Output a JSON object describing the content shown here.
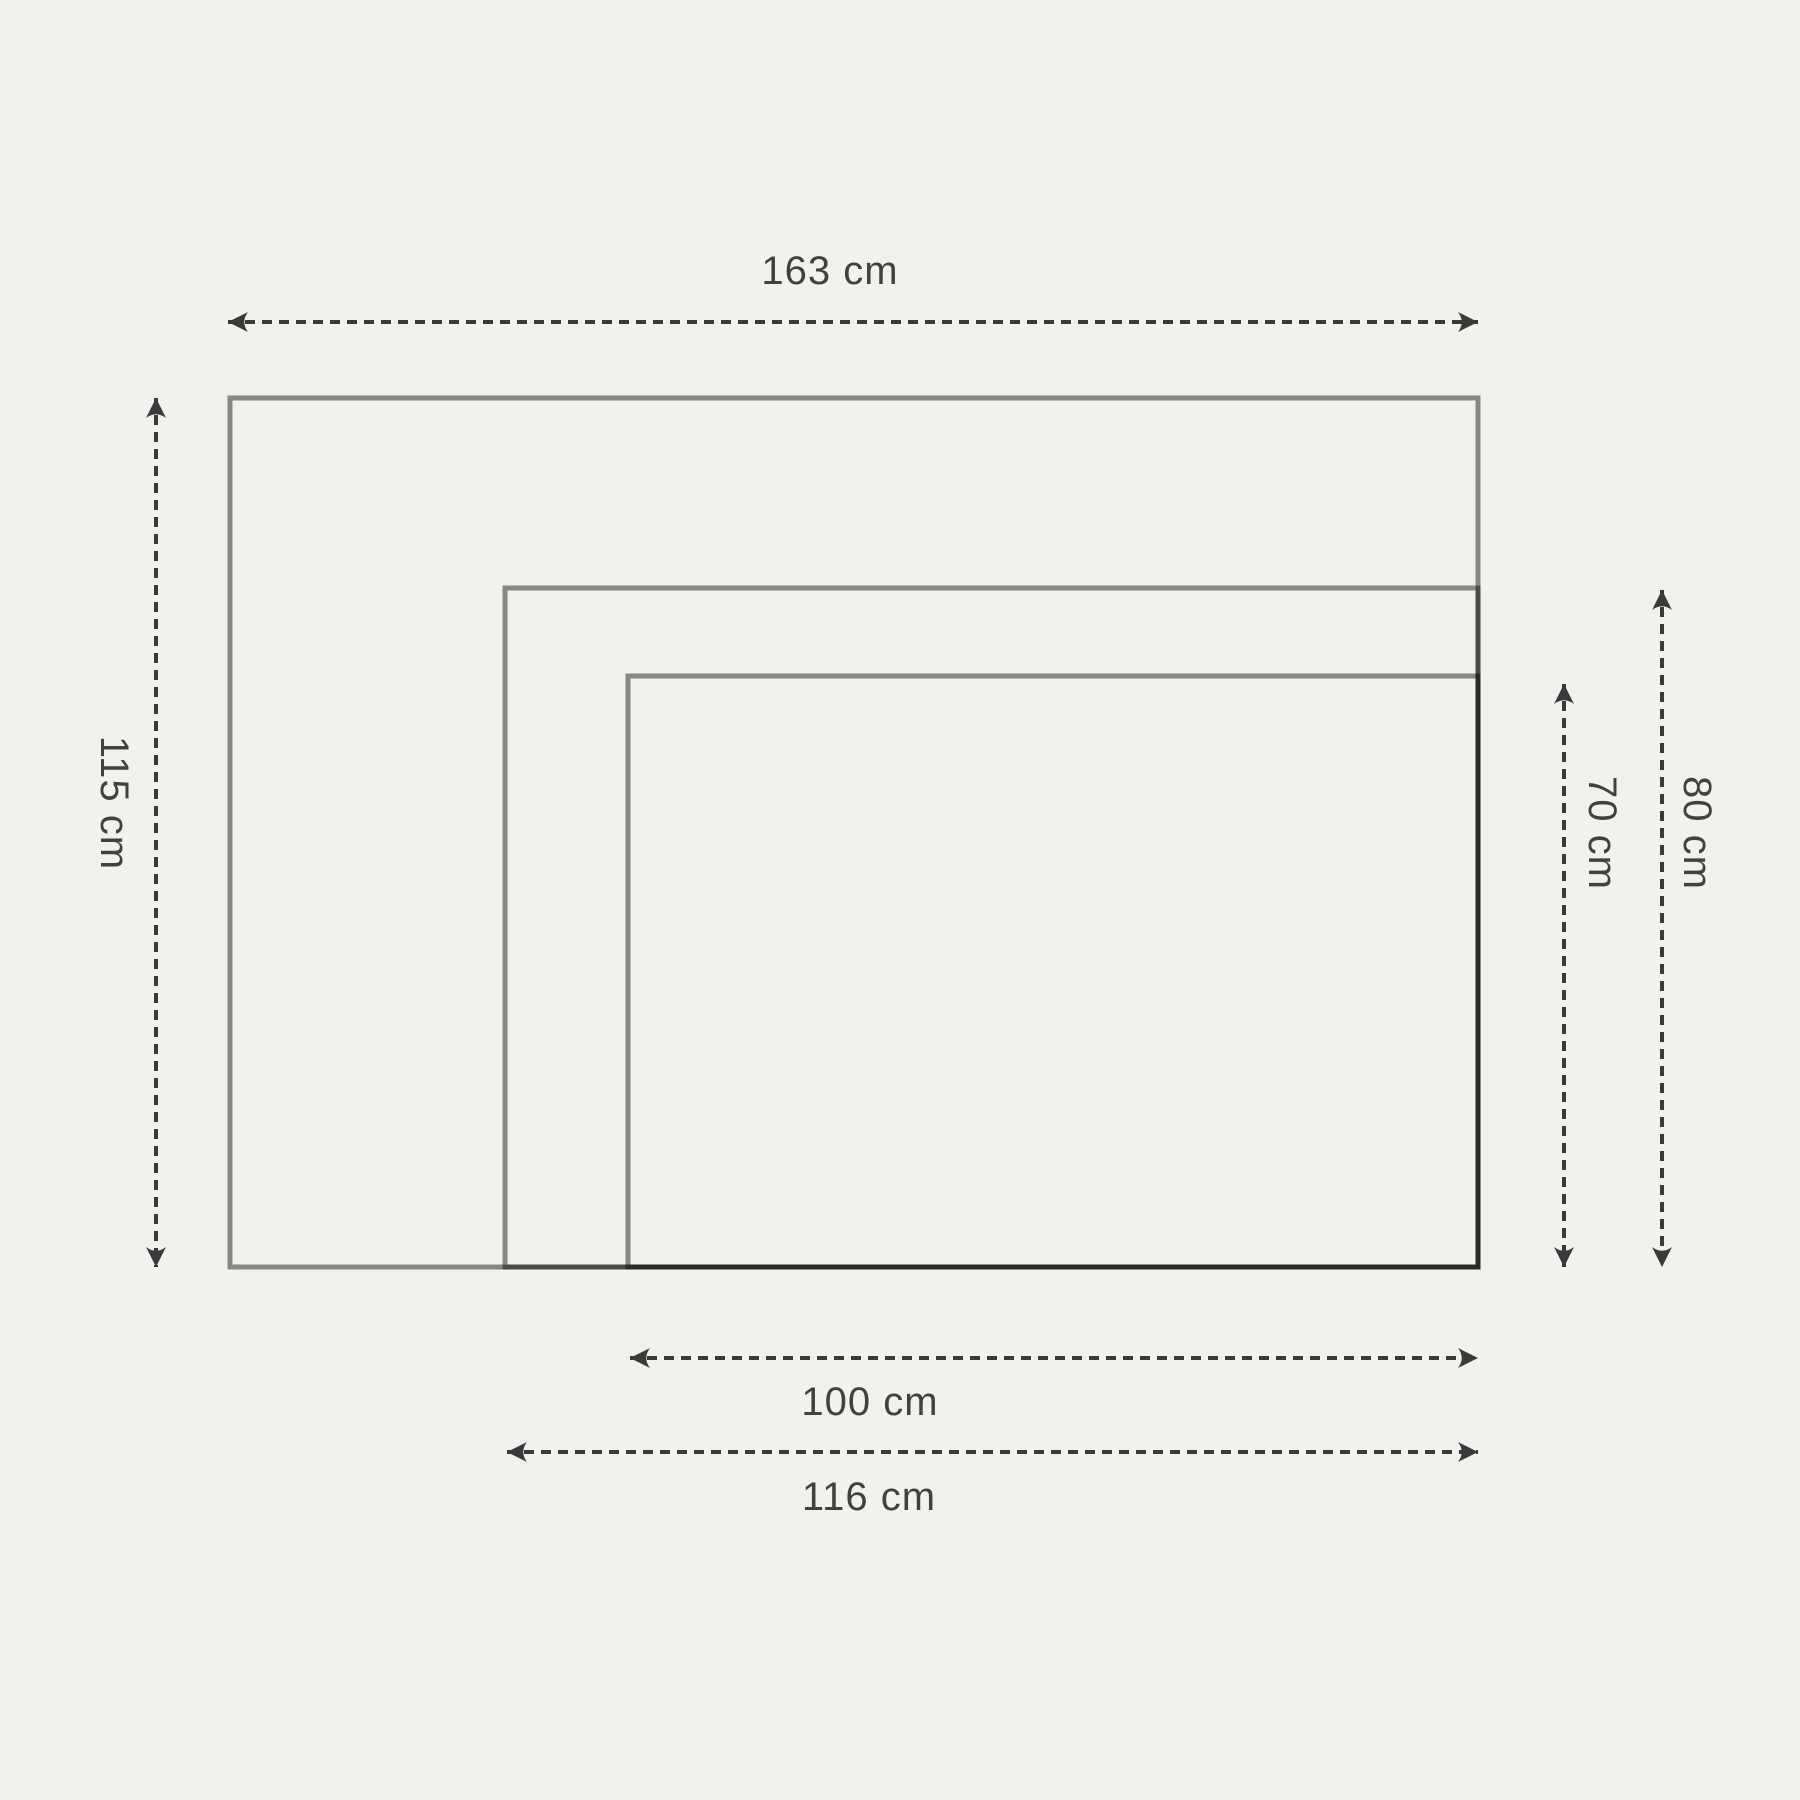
{
  "page": {
    "background_color": "#f2f1ee",
    "text_color": "#414141",
    "arrow_color": "#3a3a3a",
    "rectangle_stroke_color": "rgba(0,0,0,0.44)",
    "unit": "cm"
  },
  "diagram": {
    "type": "nested-rectangles-size-comparison",
    "labels": {
      "outer_width": "163 cm",
      "outer_height": "115 cm",
      "middle_width": "116 cm",
      "middle_height": "80 cm",
      "inner_width": "100 cm",
      "inner_height": "70 cm"
    },
    "rectangles": [
      {
        "name": "outer",
        "width_cm": 163,
        "height_cm": 115
      },
      {
        "name": "middle",
        "width_cm": 116,
        "height_cm": 80
      },
      {
        "name": "inner",
        "width_cm": 100,
        "height_cm": 70
      }
    ]
  }
}
